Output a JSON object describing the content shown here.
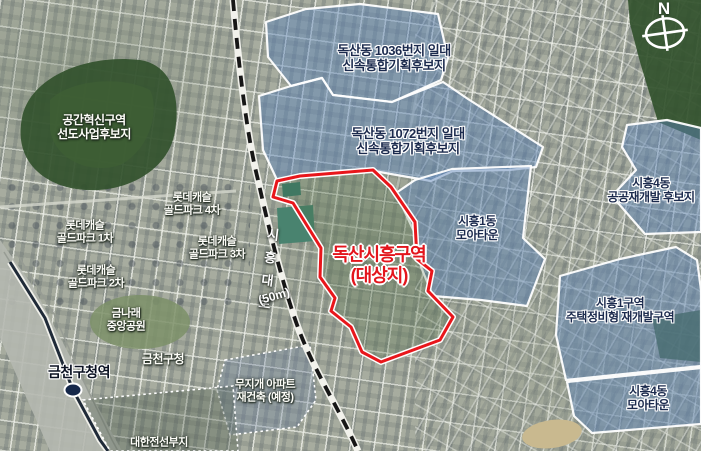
{
  "compass": {
    "north": "N"
  },
  "road": {
    "name": "시흥대로",
    "width": "(50m)"
  },
  "target_zone": {
    "line1": "독산시흥구역",
    "line2": "(대상지)",
    "outline_color": "#e8161b",
    "label_color": "#e3151c"
  },
  "candidate_zones": {
    "style": {
      "fill": "#5c83b8",
      "outline": "#ffffff",
      "label_color": "#1b2a4d"
    },
    "doksan_1036": {
      "line1": "독산동 1036번지 일대",
      "line2": "신속통합기획후보지"
    },
    "doksan_1072": {
      "line1": "독산동 1072번지 일대",
      "line2": "신속통합기획후보지"
    },
    "siheung_1dong_moa": {
      "line1": "시흥1동",
      "line2": "모아타운"
    },
    "siheung_4dong_public": {
      "line1": "시흥4동",
      "line2": "공공재개발 후보지"
    },
    "siheung_1guyeok": {
      "line1": "시흥1구역",
      "line2": "주택정비형 재개발구역"
    },
    "siheung_4dong_moa": {
      "line1": "시흥4동",
      "line2": "모아타운"
    }
  },
  "places": {
    "gonggan": {
      "line1": "공간혁신구역",
      "line2": "선도사업후보지"
    },
    "lotte_1": {
      "line1": "롯데캐슬",
      "line2": "골드파크 1차"
    },
    "lotte_2": {
      "line1": "롯데캐슬",
      "line2": "골드파크 2차"
    },
    "lotte_3": {
      "line1": "롯데캐슬",
      "line2": "골드파크 3차"
    },
    "lotte_4": {
      "line1": "롯데캐슬",
      "line2": "골드파크 4차"
    },
    "geumnarae_park": {
      "line1": "금나래",
      "line2": "중앙공원"
    },
    "gucheong": {
      "name": "금천구청"
    },
    "station": {
      "name": "금천구청역",
      "marker_color": "#16284a"
    },
    "mujigae": {
      "line1": "무지개 아파트",
      "line2": "재건축 (예정)"
    },
    "daehan": {
      "name": "대한전선부지"
    }
  }
}
